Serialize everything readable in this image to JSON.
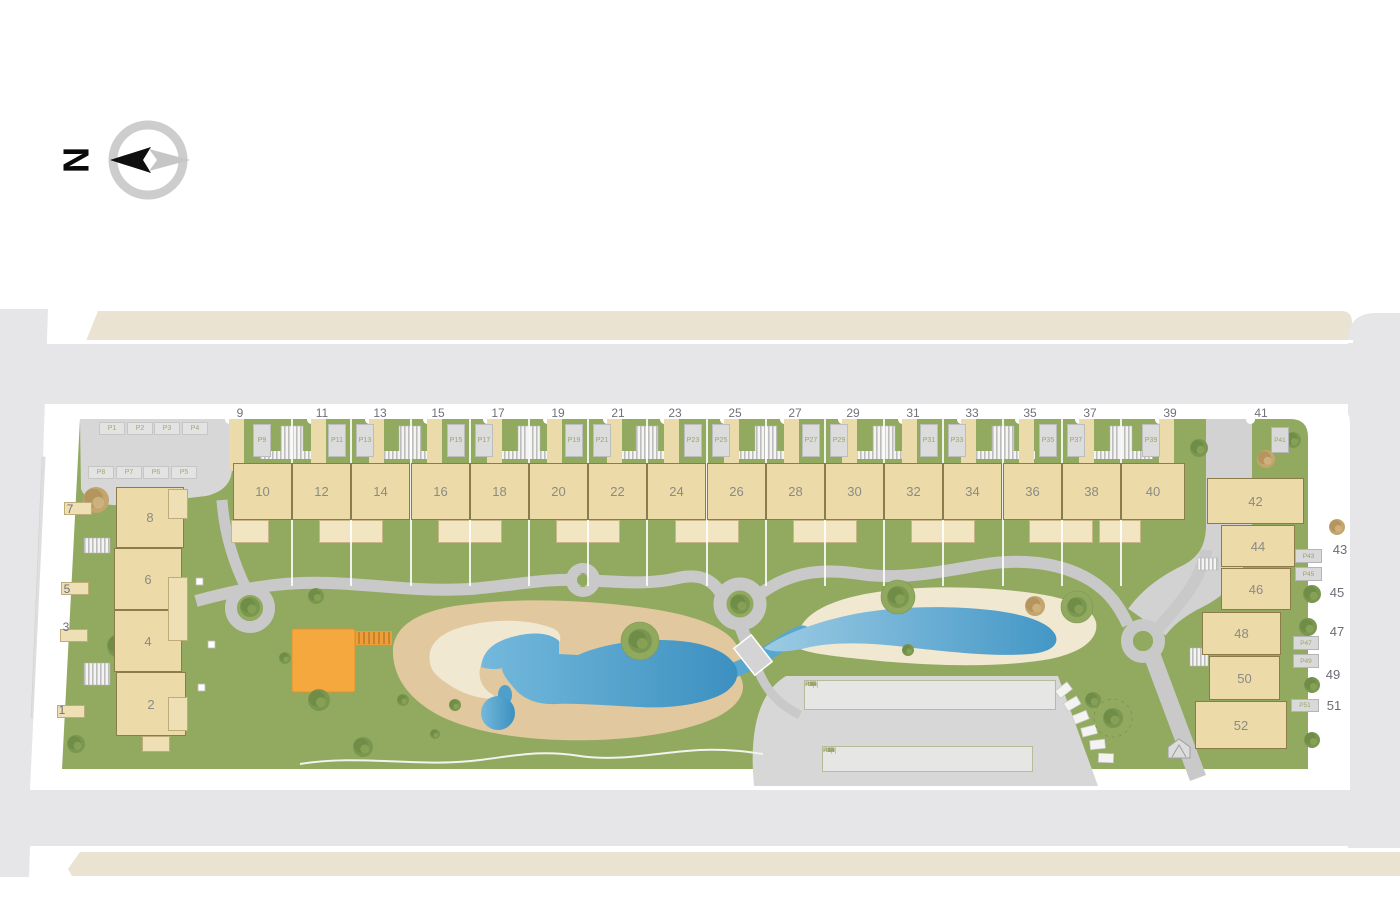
{
  "compass": {
    "label": "N"
  },
  "site": {
    "top_row": {
      "street_numbers": [
        "9",
        "11",
        "13",
        "15",
        "17",
        "19",
        "21",
        "23",
        "25",
        "27",
        "29",
        "31",
        "33",
        "35",
        "37",
        "39",
        "41"
      ],
      "house_numbers": [
        "10",
        "12",
        "14",
        "16",
        "18",
        "20",
        "22",
        "24",
        "26",
        "28",
        "30",
        "32",
        "34",
        "36",
        "38",
        "40"
      ],
      "parking_labels": [
        "P9",
        "P11",
        "P13",
        "P15",
        "P17",
        "P19",
        "P21",
        "P23",
        "P25",
        "P27",
        "P29",
        "P31",
        "P33",
        "P35",
        "P37",
        "P39"
      ]
    },
    "left_block": {
      "street_numbers": [
        "7",
        "5",
        "3",
        "1"
      ],
      "house_numbers": [
        "8",
        "6",
        "4",
        "2"
      ],
      "parking_row_top": [
        "P1",
        "P2",
        "P3",
        "P4"
      ],
      "parking_row_bottom": [
        "P8",
        "P7",
        "P6",
        "P5"
      ]
    },
    "right_block": {
      "street_numbers": [
        "43",
        "45",
        "47",
        "49",
        "51"
      ],
      "house_numbers": [
        "42",
        "44",
        "46",
        "48",
        "50",
        "52"
      ],
      "parking_labels": [
        "P41",
        "P43",
        "P45",
        "P47",
        "P49",
        "P51"
      ]
    },
    "central_parking": {
      "row_top": [
        "R6",
        "R5",
        "R3",
        "R1",
        "P50",
        "P46",
        "P42",
        "P38",
        "P34",
        "P30",
        "P26",
        "P22",
        "P18",
        "P14",
        "P10"
      ],
      "row_bottom": [
        "R4",
        "R2",
        "P52",
        "P48",
        "P44",
        "P40",
        "P36",
        "P32",
        "P28",
        "P24",
        "P20",
        "P16",
        "P12"
      ]
    }
  },
  "colors": {
    "site_green": "#92aa60",
    "building_beige": "#ecdba8",
    "patio_beige": "#f2e6c2",
    "road_gray": "#e6e6e8",
    "pavement_gray": "#d7d7d7",
    "path_gray": "#c9c9c9",
    "pool_blue": "#4a9dc9",
    "sand_tan": "#e2c89e",
    "cream": "#f1e8d2",
    "playground_orange": "#f4a83e",
    "neighbor_band_beige": "#eae3d1",
    "parking_label_olive": "#9aa46c"
  }
}
